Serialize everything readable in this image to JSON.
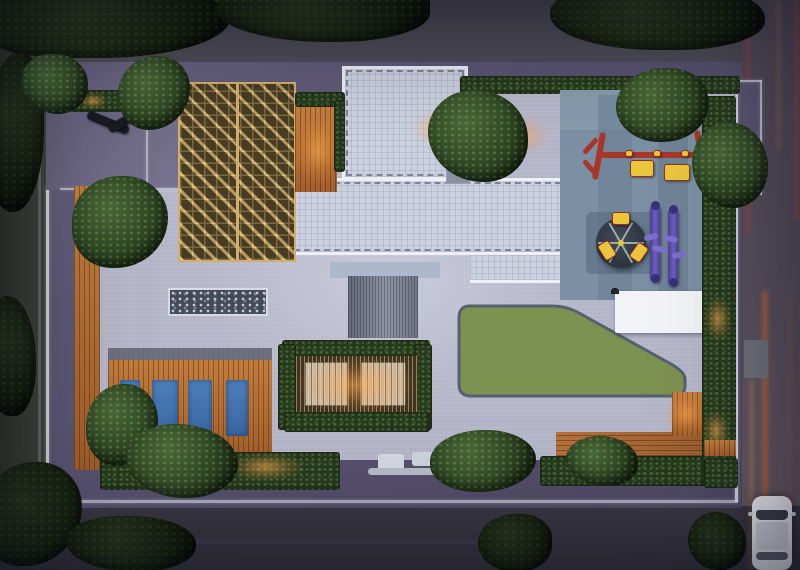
{
  "scene": {
    "type": "architectural-aerial-render",
    "title": "Aerial dusk render of a residential podium / rooftop amenity master plan",
    "time_of_day": "dusk",
    "visible_text": "none"
  },
  "palette": {
    "road_top": "#4a4953",
    "road_left": "#3d4239",
    "road_right": "#5a5360",
    "road_bottom": "#36343e",
    "podium": "#5a5470",
    "paving": "#b6b7c9",
    "roof_tile": "#ccd1e0",
    "roof_edge": "#eef0f6",
    "lawn": "#7d9150",
    "wood_deck": "#b5713d",
    "pergola_gold": "#c29a5e",
    "play_mat": "#7b90a4",
    "play_red": "#a8372a",
    "play_yellow": "#e9c63c",
    "gym_purple": "#5b50ac",
    "pool_mat_blue": "#4676b4",
    "hedge_green": "#263a1e",
    "tree_green": "#3c5831",
    "glow_warm": "#ffac52",
    "car_white": "#e8e9ee",
    "pebble_dark": "#454a58"
  },
  "features": {
    "roads": {
      "top": "tree-lined street, canopies overhanging",
      "left": "dark side street with trees",
      "right": "street with red/amber car light trails and a white car",
      "bottom": "dark street with entrance drop-off"
    },
    "building": {
      "roof": "white-edged tiled roof, T-shaped, dashed parapet detail",
      "entrance_canopy": "ribbed grey canopy at centre",
      "street_canopy": "small white drop-off canopy at bottom edge"
    },
    "amenities": [
      {
        "name": "seating-terrace",
        "detail": "two dark loungers on purple deck, lit hedge"
      },
      {
        "name": "golden-pergola-trellis",
        "detail": "lattice with triangular louvres"
      },
      {
        "name": "pebble-water-feature",
        "detail": "dark rectangle of pebbles with pale border"
      },
      {
        "name": "sun-deck",
        "detail": "timber deck with four blue lounger mats and white shell sculpture"
      },
      {
        "name": "green-pavilion",
        "detail": "slatted roof with two warm-lit skylights, vine-covered"
      },
      {
        "name": "lawn",
        "detail": "curved green lawn with dark border"
      },
      {
        "name": "kids-play-area",
        "detail": "blue rubber mat, red/yellow swing frame, carousel with yellow seats"
      },
      {
        "name": "outdoor-gym",
        "detail": "two purple elliptical machines"
      },
      {
        "name": "game-tile-court",
        "detail": "painted 8x3 tile board with animal glyphs"
      }
    ],
    "vehicle": {
      "type": "white hatchback",
      "location": "right road, bottom"
    }
  },
  "counts": {
    "blue_mats": 4,
    "loungers": 2,
    "swing_seats": 2,
    "carousel_seats": 3,
    "gym_machines": 2,
    "mosaic_rows": 3,
    "mosaic_cols": 8
  },
  "mosaic": {
    "cells": [
      "w",
      "w",
      "w",
      "w",
      "y",
      "w",
      "w",
      "y",
      "y",
      "r",
      "y",
      "d",
      "w",
      "w",
      "d",
      "w",
      "w",
      "d",
      "w",
      "w",
      "w",
      "y",
      "d",
      "w"
    ]
  },
  "light_trails": [
    {
      "x": 746,
      "y": 0,
      "w": 3,
      "h": 235,
      "c": "rgba(205,62,52,0.50)"
    },
    {
      "x": 795,
      "y": 0,
      "w": 4,
      "h": 220,
      "c": "rgba(195,75,60,0.45)"
    },
    {
      "x": 777,
      "y": 0,
      "w": 3,
      "h": 150,
      "c": "rgba(210,130,70,0.35)"
    },
    {
      "x": 762,
      "y": 290,
      "w": 6,
      "h": 280,
      "c": "rgba(235,110,50,0.50)"
    },
    {
      "x": 750,
      "y": 380,
      "w": 3,
      "h": 190,
      "c": "rgba(245,165,75,0.40)"
    },
    {
      "x": 788,
      "y": 300,
      "w": 3,
      "h": 270,
      "c": "rgba(200,90,60,0.30)"
    },
    {
      "x": 80,
      "y": 540,
      "w": 420,
      "h": 3,
      "c": "rgba(165,155,175,0.14)"
    },
    {
      "x": 240,
      "y": 554,
      "w": 380,
      "h": 2,
      "c": "rgba(165,155,175,0.10)"
    }
  ]
}
